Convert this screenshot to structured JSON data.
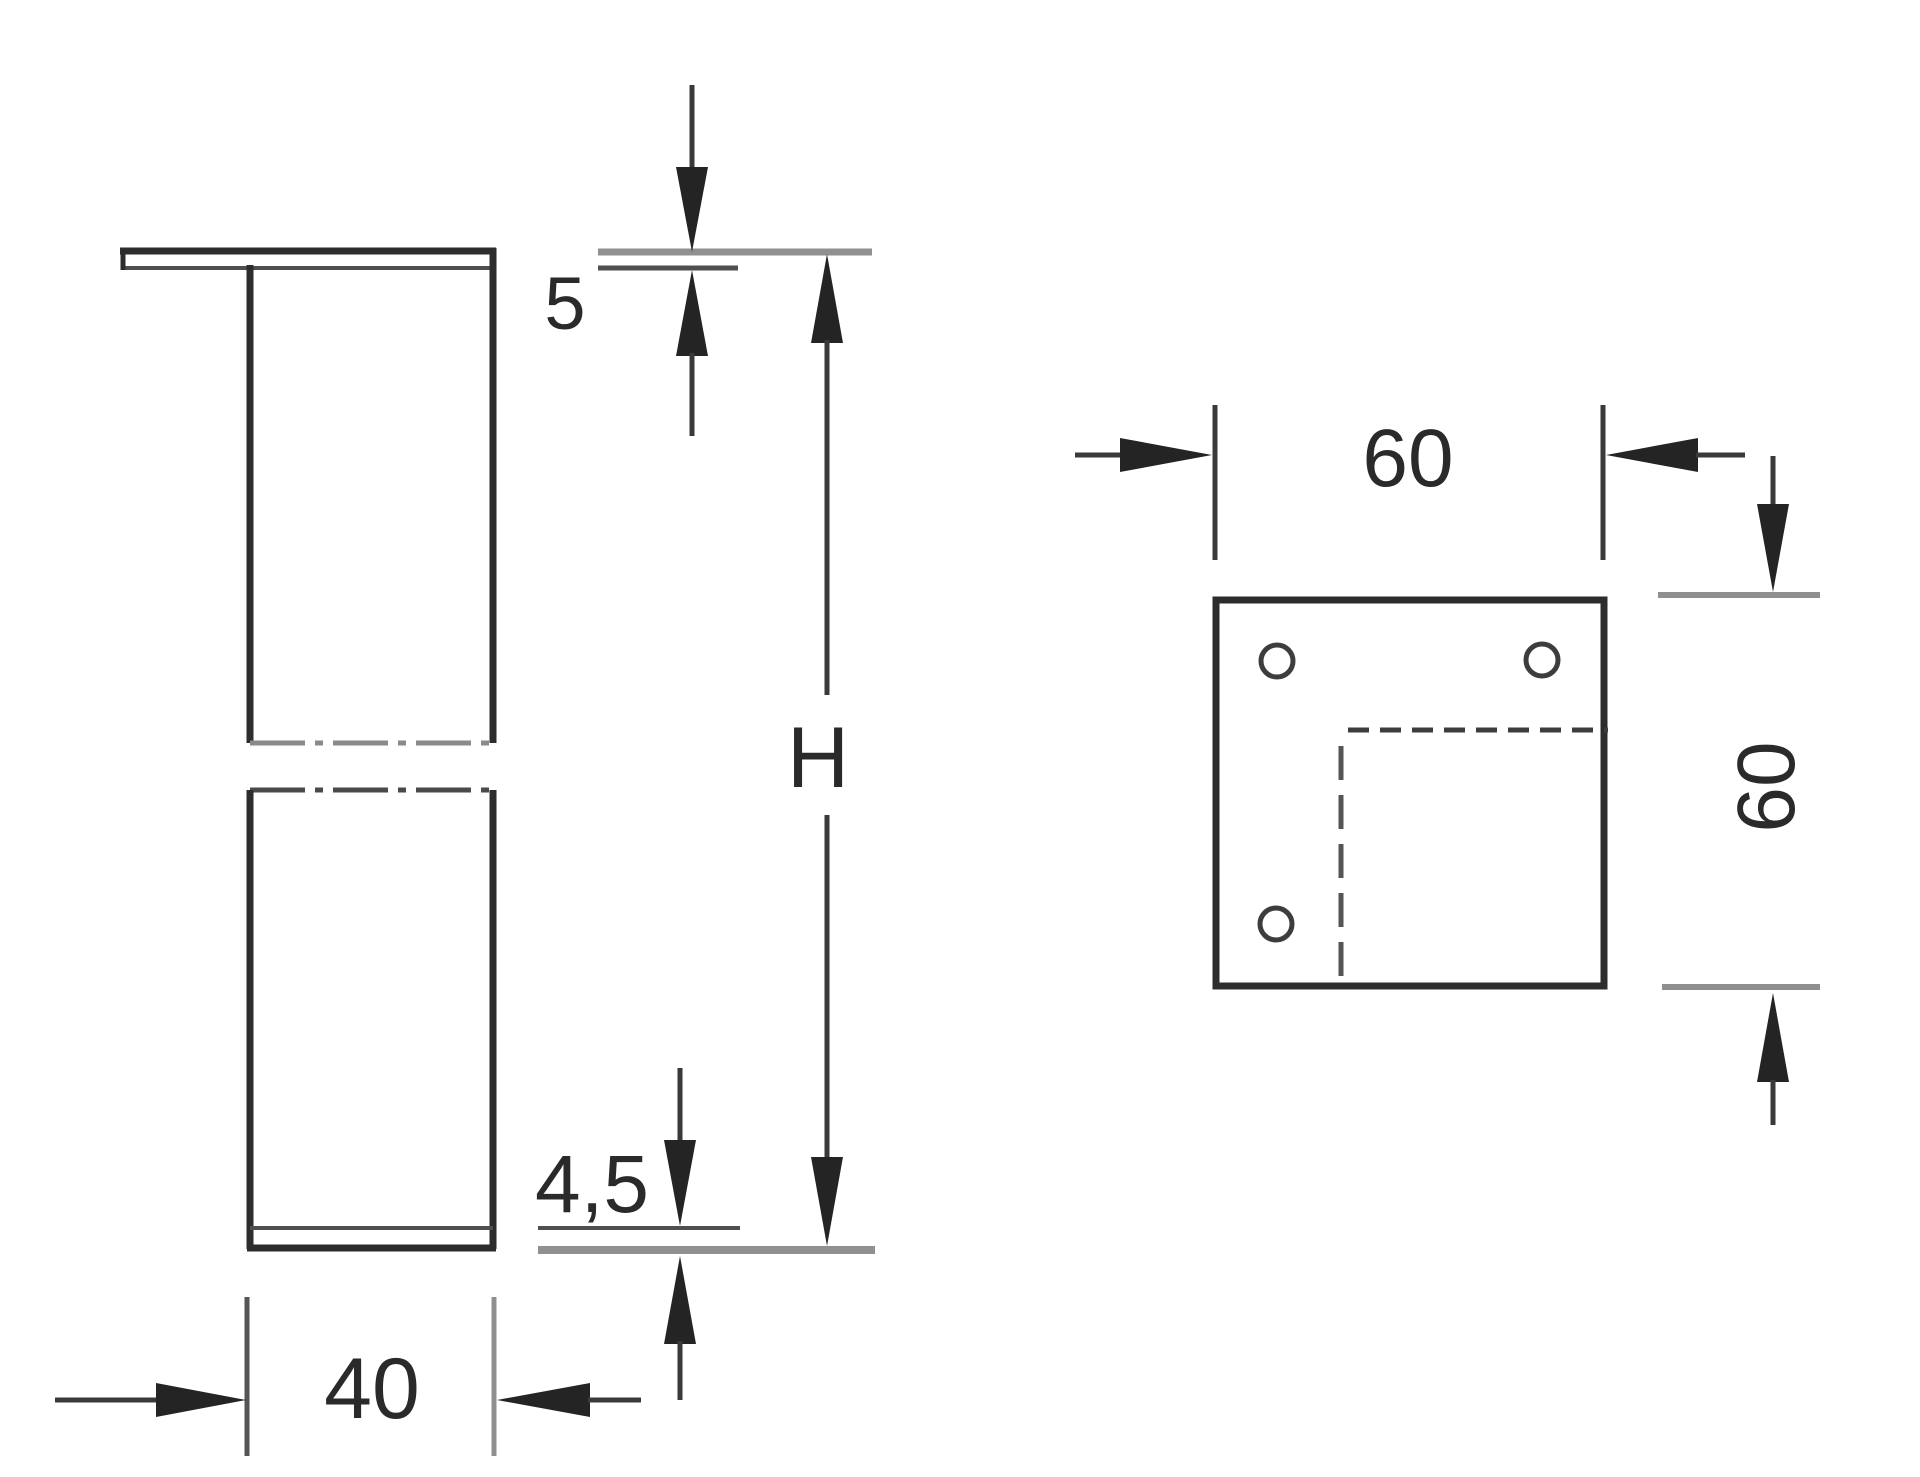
{
  "drawing": {
    "background_color": "#ffffff",
    "line_color": "#2d2d2d",
    "gray_line_color": "#909090",
    "views": {
      "side_view": {
        "dimensions": {
          "plate_thickness": "5",
          "leg_height": "H",
          "foot_plate_thickness": "4,5",
          "leg_width": "40"
        }
      },
      "top_view": {
        "dimensions": {
          "plate_width": "60",
          "plate_depth": "60"
        },
        "screw_hole_count": 3
      }
    }
  }
}
